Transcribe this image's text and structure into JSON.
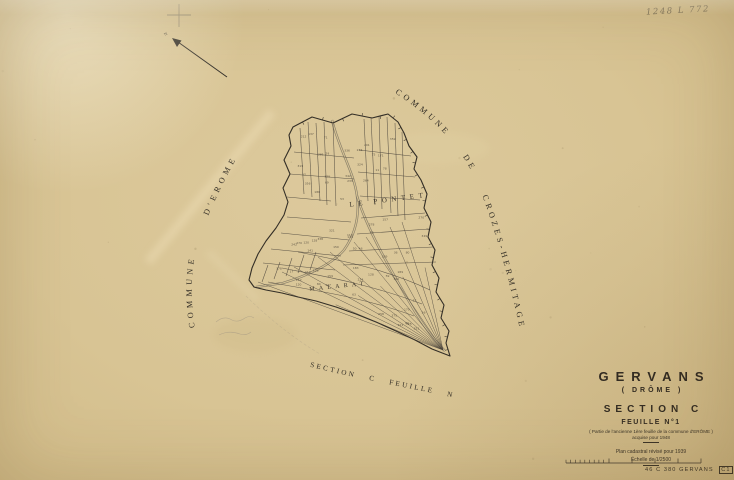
{
  "annotations": {
    "pencil_note": "1248 L 772"
  },
  "map_labels": {
    "commune_left": "COMMUNE D'EROME",
    "commune_right": "COMMUNE DE CROZES-HERMITAGE",
    "lieu_dit_north": "LE PONTET",
    "lieu_dit_south": "MALARAT",
    "adjacent_sheet": "SECTION C FEUILLE N°2"
  },
  "title_block": {
    "commune": "GERVANS",
    "department": "( DRÔME )",
    "section": "SECTION C",
    "sheet": "FEUILLE N°1",
    "parenthetical": "( Partie de l'ancienne 1ère feuille de la commune d'ERÔME )",
    "acquisition": "acquise pour 1948",
    "revision": "Plan cadastral révisé pour 1939",
    "scale": "Échelle de 1/2500"
  },
  "footer": {
    "stamp": "46 C 380 GERVANS",
    "stamp_ref": "C1"
  },
  "map": {
    "parcel_numbers": "illegible small parcel numbers"
  },
  "colors": {
    "paper": "#d8c494",
    "ink": "#332e27",
    "pencil": "#8e8471",
    "road": "#7c7464"
  }
}
